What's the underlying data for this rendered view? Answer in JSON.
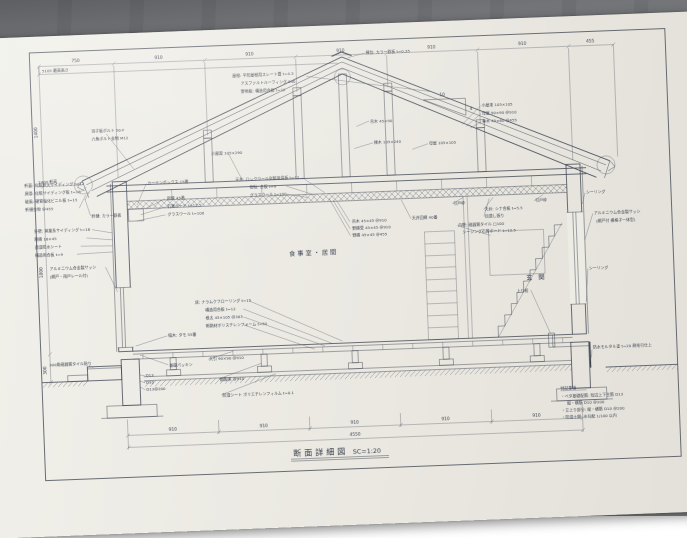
{
  "photo": {
    "surface_color": "#8a8b8f",
    "paper_color": "#eae8e1",
    "ink_color": "#3c4250"
  },
  "title": {
    "name": "断面詳細図",
    "scale": "SC=1:20"
  },
  "dimensions": {
    "top": [
      "750",
      "910",
      "910",
      "910",
      "910",
      "910",
      "455"
    ],
    "bottom": [
      "910",
      "910",
      "910",
      "910",
      "910"
    ],
    "bottom_total": "4550",
    "left_height_max": "5105 最高高さ",
    "left_eave_height": "2400 軒高",
    "left_vertical": [
      "1400",
      "1800",
      "300"
    ],
    "pitch": {
      "run": "10",
      "rise": "4"
    }
  },
  "rooms": {
    "living": "食事室・居間",
    "entrance": "玄 関",
    "kamachi": "上り框"
  },
  "labels": {
    "roof": [
      "屋根: 平形屋根用スレート葺 t=4.5",
      "アスファルトルーフィング 940",
      "野地板: 構造用合板 t=12"
    ],
    "ridge": "棟包: カラー鉄板 t=0.35",
    "members_right": [
      "小屋束 105×105",
      "母屋 90×90 @910",
      "垂木 45×60 @455"
    ],
    "member_tsurigi": "吊木 45×90",
    "member_munagi": "棟木 105×240",
    "member_moya": "母屋 105×105",
    "member_koyabari": "小屋梁 105×290",
    "bolts": [
      "羽子板ボルト 50-F",
      "六角ボルト金物 M12"
    ],
    "eave": [
      "軒裏: 化粧軒天サイディング t=12",
      "鼻隠: 化粧サイディング板 t=16",
      "破風: 硬質塩化ビニル板 t=15",
      "軒樋金物 @455"
    ],
    "gutter": "軒樋: カラー鉄板",
    "wall_left": [
      "外壁: 窯業系サイディング t=16",
      "胴縁 18×45",
      "透湿防水シート",
      "構造用合板 t=9"
    ],
    "sash_left": [
      "アルミニウム合金製サッシ",
      "(網戸・雨戸レール付)"
    ],
    "curtain_box": "カーテンボックス 15番",
    "trim": [
      "廻縁 45番",
      "石膏ボード t=12.5",
      "グラスウール t=100"
    ],
    "ceiling": [
      "天井: ロックウール化粧吸音板 t=12",
      "捨貼: 合板 t=9",
      "グラスウール t=100"
    ],
    "furring": [
      "吊木 45×45 @910",
      "野縁受 45×45 @910",
      "野縁 45×45 @455"
    ],
    "ceiling_trim": "天井回縁 40番",
    "door_frame": "引戸枠",
    "ceiling_right": [
      "天井: シナ合板 t=5.5",
      "目透し張り"
    ],
    "wall_tile": [
      "内壁: 磁器質タイル □100",
      "シージング石膏ボード t=12.5"
    ],
    "sealing": "シーリング",
    "sash_right": [
      "アルミニウム合金製サッシ",
      "(網戸付 横格子一体型)"
    ],
    "floor": [
      "床: ナラムクフローリング t=15",
      "構造用合板 t=12",
      "根太 45×105 @303",
      "断熱材ポリスチレンフォーム t=50"
    ],
    "baseboard": "幅木: タモ 55番",
    "tile_floor": "300角磁器質タイル貼り",
    "packing": "基礎パッキン",
    "sleeper": "大引 90×90 @910",
    "rebar": [
      "D13",
      "D10",
      "D13@200"
    ],
    "floor_post": "鋼製束 @910",
    "moisture": "防湿シート ポリエチレンフィルム t=0.1",
    "mortar": "防水モルタル塗 t=20 刷毛引仕上",
    "notes": [
      "特記事項",
      "・ベタ基礎配筋: 短辺上下主筋 D13",
      "縦・横筋 D10 @200",
      "・立上り部分: 縦・横筋 D10 @200",
      "・防湿土間: 水勾配 1/100 以内"
    ]
  }
}
